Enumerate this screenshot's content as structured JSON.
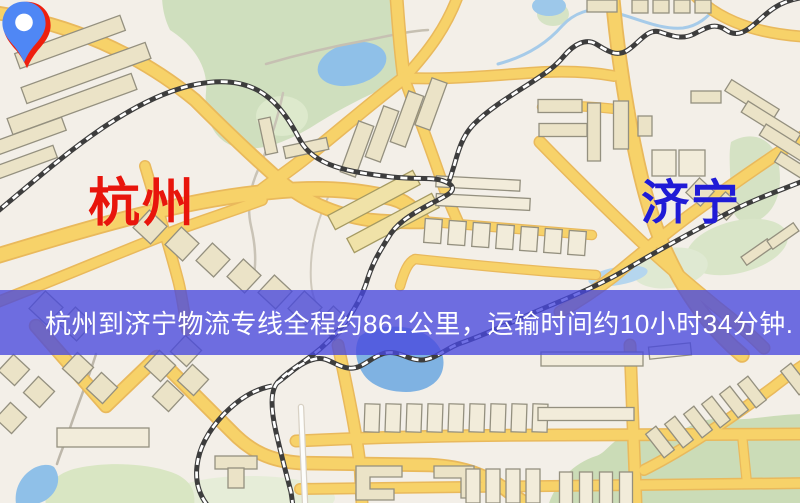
{
  "labels": {
    "origin": "杭州",
    "destination": "济宁"
  },
  "banner": {
    "text": "杭州到济宁物流专线全程约861公里，运输时间约10小时34分钟."
  },
  "route_info": {
    "origin_city": "杭州",
    "destination_city": "济宁",
    "distance_text": "全程约861公里",
    "duration_text": "运输时间约10小时34分钟"
  },
  "theme": {
    "land": "#f3efe8",
    "road-fill": "#f7d269",
    "road-casing": "#e9b95c",
    "water": "#8fc0e8",
    "park": "#cfdfbe",
    "building-fill": "#ebe3c7",
    "building-stroke": "#94907f",
    "rail-dark": "#3d3d3d",
    "rail-light": "#ffffff",
    "origin-color": "#e8150c",
    "origin-pin": "#ee1f0e",
    "dest-color": "#201bd6",
    "dest-pin": "#4f87f5",
    "banner-bg": "rgba(72,72,222,0.78)",
    "banner-text": "#ffffff"
  }
}
